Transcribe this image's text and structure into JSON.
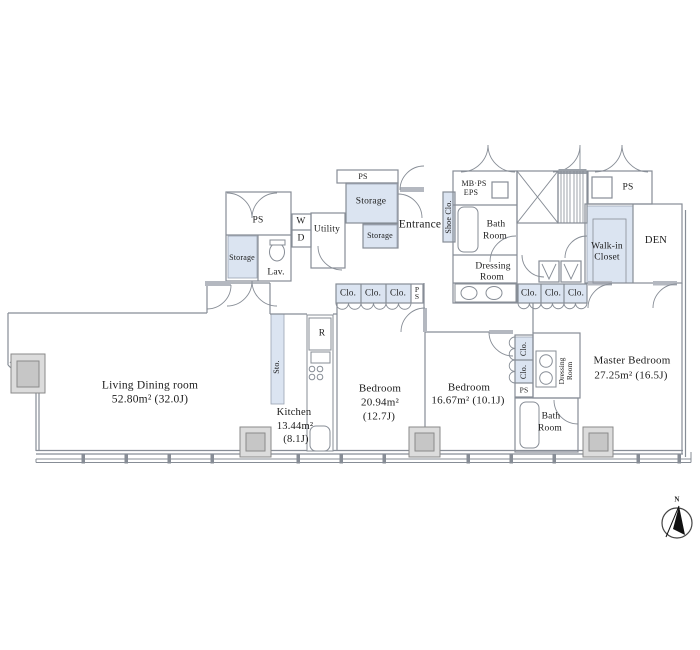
{
  "labels": {
    "clo": "Clo.",
    "ps": "PS",
    "storage": "Storage",
    "lav": "Lav.",
    "w": "W",
    "d": "D",
    "utility": "Utility",
    "entrance": "Entrance",
    "shoe_clo": "Shoe Clo.",
    "mb_ps": "MB·PS",
    "eps": "EPS",
    "bath": "Bath",
    "room": "Room",
    "dressing": "Dressing",
    "walk_in": "Walk-in",
    "closet": "Closet",
    "den": "DEN",
    "fridge": "R",
    "sto": "Sto.",
    "north": "N"
  },
  "rooms": {
    "living": {
      "name": "Living Dining room",
      "area": "52.80m²  (32.0J)"
    },
    "kitchen": {
      "name": "Kitchen",
      "area": "13.44m²",
      "jo": "(8.1J)"
    },
    "bedroom1": {
      "name": "Bedroom",
      "area": "20.94m²",
      "jo": "(12.7J)"
    },
    "bedroom2": {
      "name": "Bedroom",
      "area": "16.67m²  (10.1J)"
    },
    "master_bedroom": {
      "name": "Master Bedroom",
      "area": "27.25m²  (16.5J)"
    }
  },
  "colors": {
    "closet_fill": "#dbe4f1",
    "wall": "#878d96"
  }
}
